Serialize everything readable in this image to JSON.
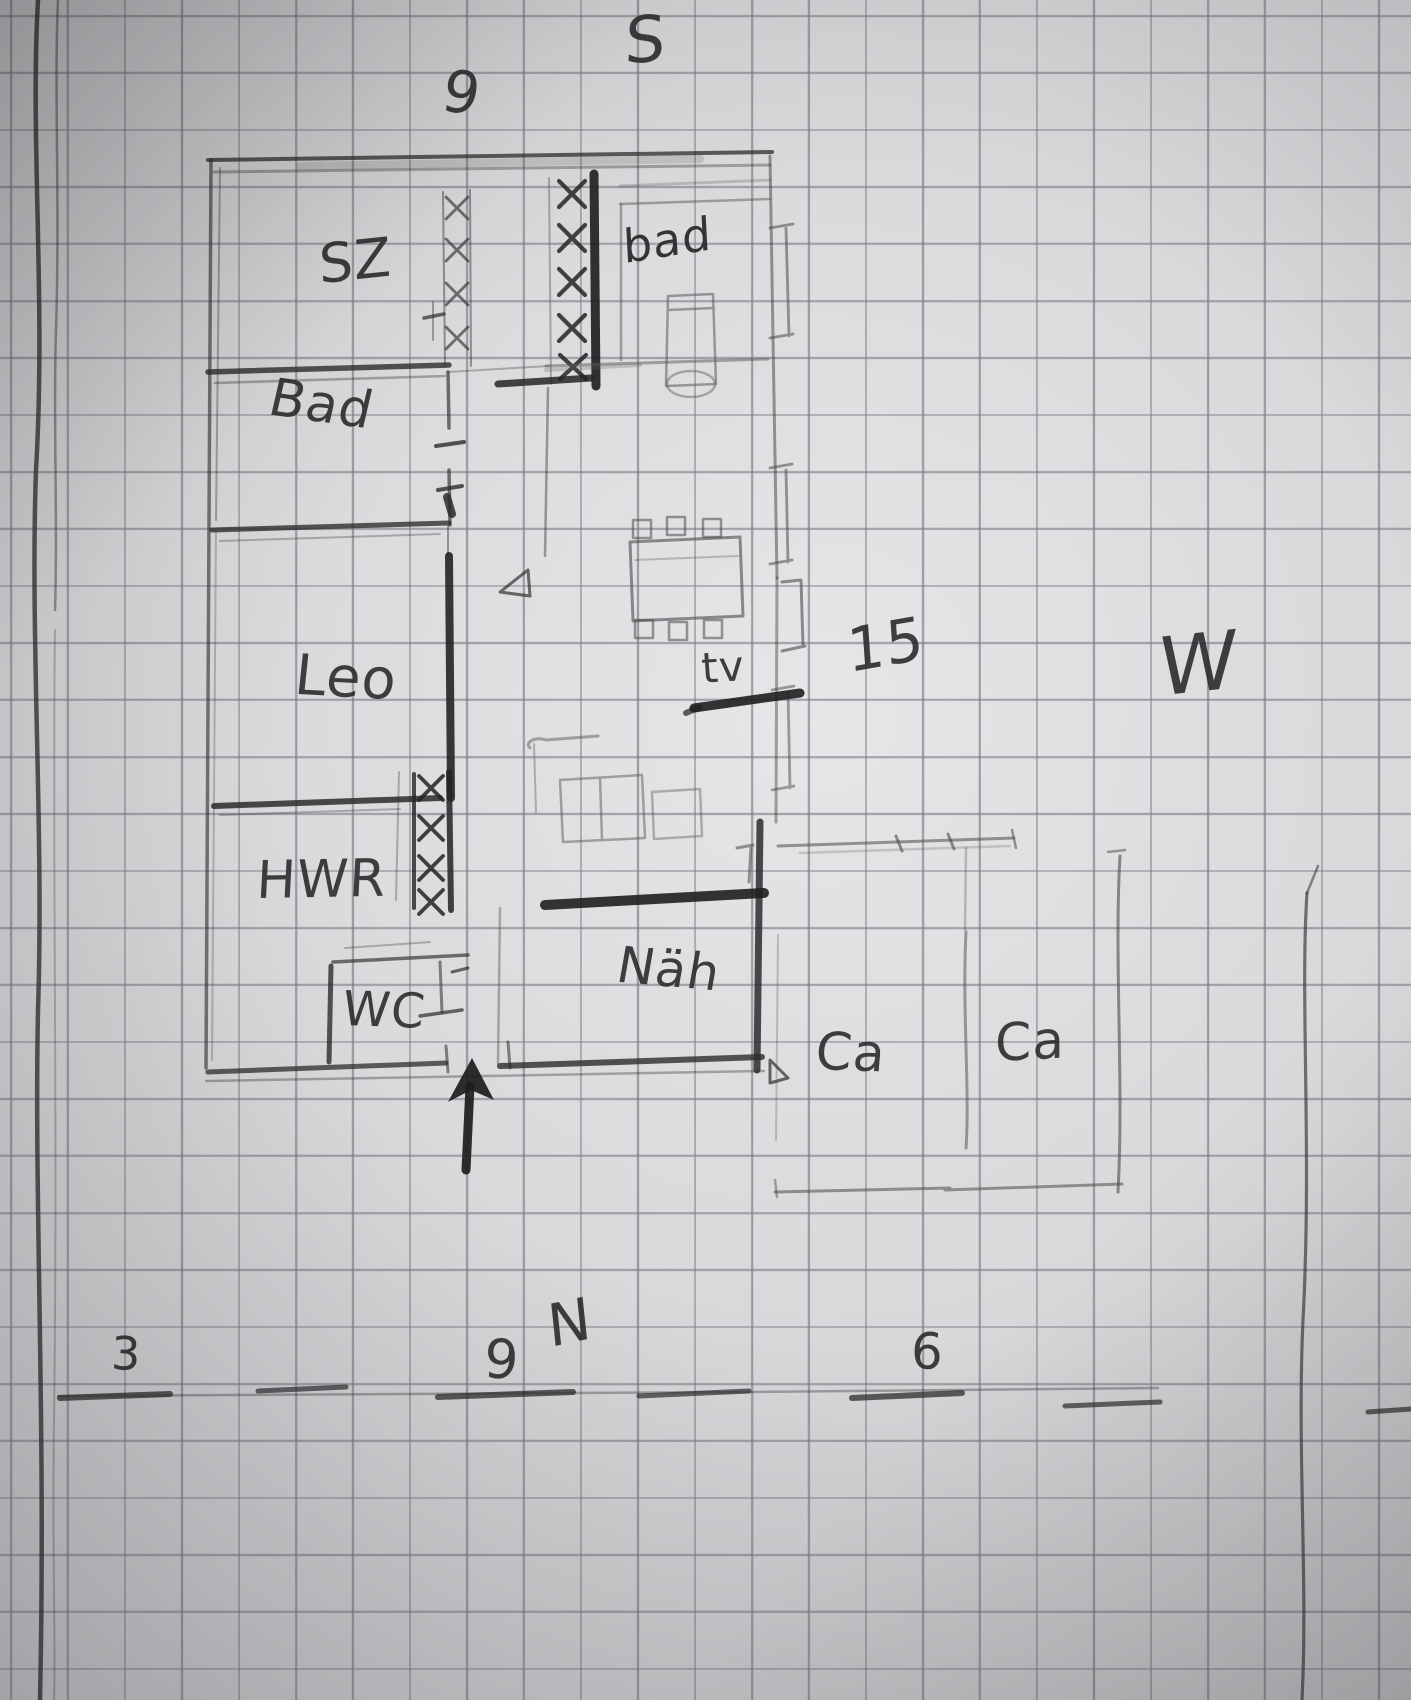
{
  "artwork": {
    "description": "Hand-drawn floor plan sketch in pencil on squared graph paper",
    "palette": {
      "paper": "#d9d9db",
      "grid_line": "#78787f",
      "pencil_dark": "#2c2c2e",
      "pencil_light": "#8a8a8c"
    }
  },
  "compass": {
    "south_label": "S",
    "north_label": "N",
    "west_label": "W"
  },
  "dimensions": {
    "top_width": "9",
    "bottom_left": "3",
    "bottom_center": "9",
    "bottom_right": "6"
  },
  "rooms": {
    "bedroom": {
      "label": "SZ"
    },
    "bath_small": {
      "label": "bad"
    },
    "bath": {
      "label": "Bad"
    },
    "leo": {
      "label": "Leo"
    },
    "utility": {
      "label": "HWR"
    },
    "toilet": {
      "label": "WC"
    },
    "kitchen": {
      "label": "Näh"
    },
    "living": {
      "tv_label": "tv",
      "area_label": "15"
    }
  },
  "carport": {
    "left_label": "Ca",
    "right_label": "Ca"
  }
}
